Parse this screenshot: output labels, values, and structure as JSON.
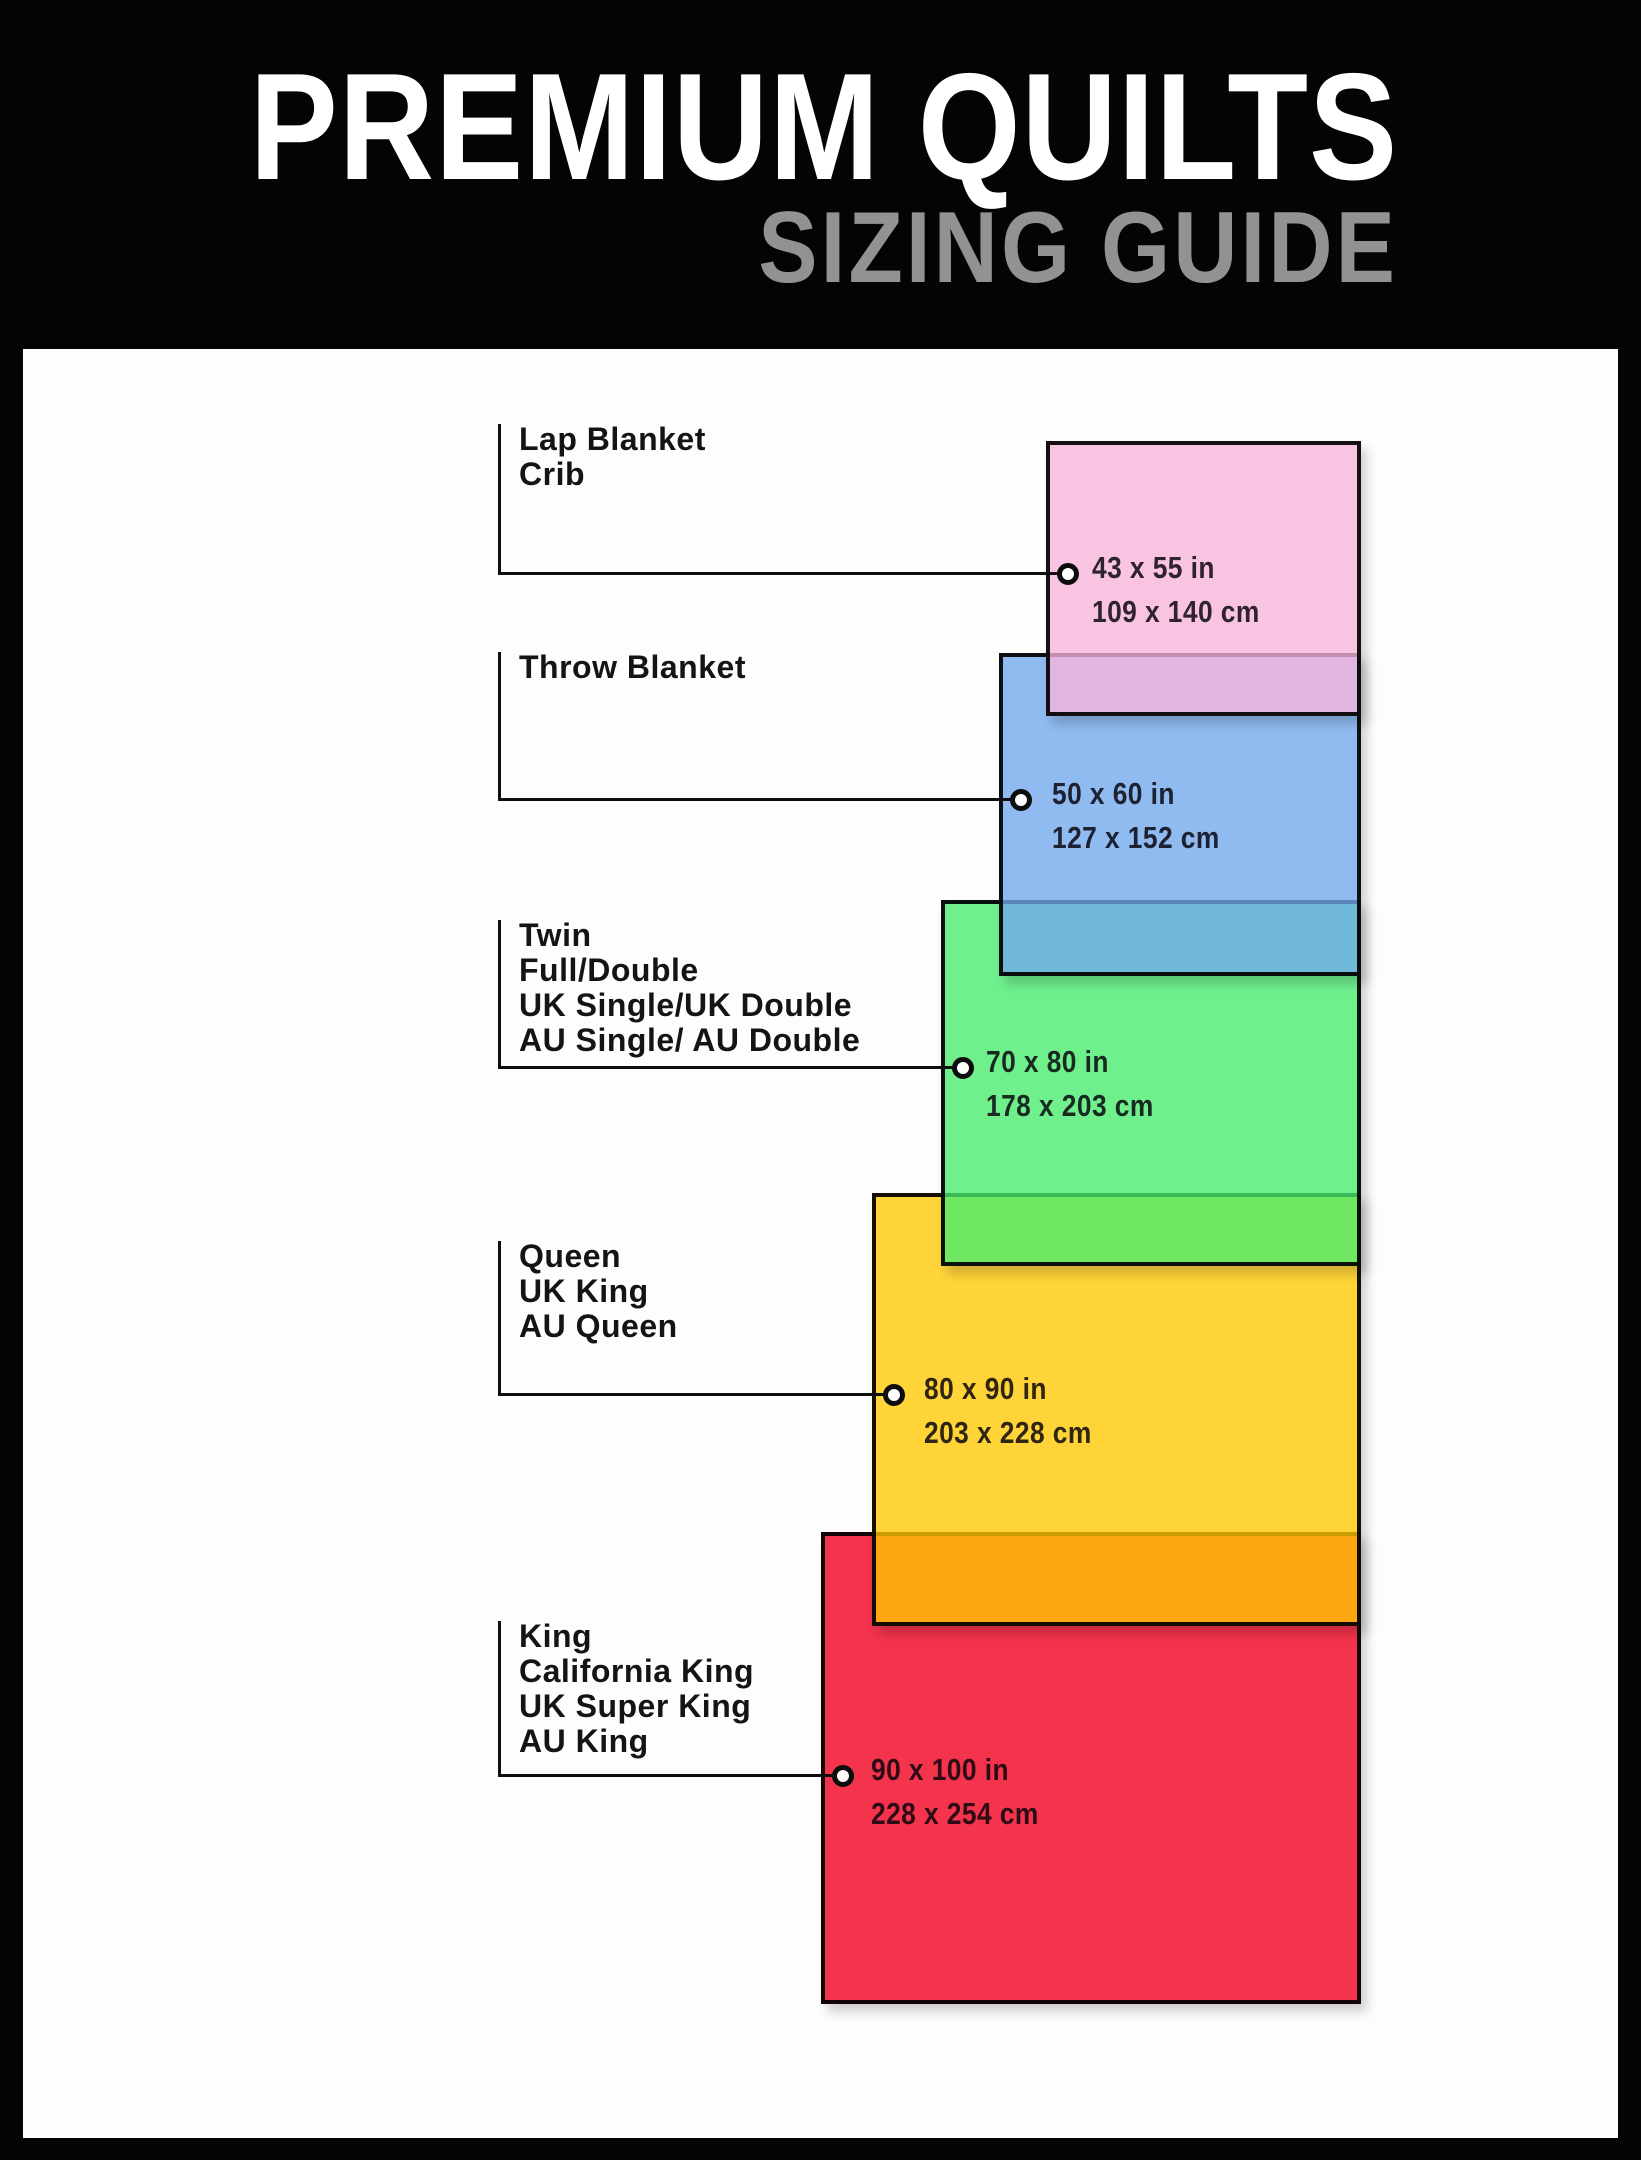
{
  "header": {
    "title": "PREMIUM QUILTS",
    "subtitle": "SIZING GUIDE",
    "background": "#040404",
    "title_color": "#ffffff",
    "subtitle_color": "#929292"
  },
  "layout": {
    "page_width": 1641,
    "page_height": 2160,
    "content_area": {
      "left": 23,
      "top": 349,
      "width": 1595,
      "height": 1789,
      "background": "#fdfdfd"
    },
    "label_text_x": 519,
    "leader_line_x": 498,
    "leader_line_color": "#0e0e0e",
    "rects_right_edge": 1361
  },
  "sizes": [
    {
      "id": "lap-blanket-crib",
      "labels": [
        "Lap Blanket",
        "Crib"
      ],
      "inches": "43 x 55 in",
      "cm": "109 x 140 cm",
      "fill": "rgba(247,179,218,0.78)",
      "display_color": "#f9c4e2",
      "rect": {
        "left": 1046,
        "top": 441,
        "width": 315,
        "height": 275
      },
      "label_y": 422,
      "leader_y": 574,
      "dims_x": 1092,
      "z": 50
    },
    {
      "id": "throw-blanket",
      "labels": [
        "Throw Blanket"
      ],
      "inches": "50 x 60 in",
      "cm": "127 x 152 cm",
      "fill": "rgba(111,168,237,0.78)",
      "display_color": "#8fbbf1",
      "rect": {
        "left": 999,
        "top": 653,
        "width": 362,
        "height": 323
      },
      "label_y": 650,
      "leader_y": 800,
      "dims_x": 1052,
      "z": 40
    },
    {
      "id": "twin-full-double",
      "labels": [
        "Twin",
        "Full/Double",
        "UK Single/UK Double",
        "AU Single/ AU Double"
      ],
      "inches": "70 x 80 in",
      "cm": "178 x 203 cm",
      "fill": "rgba(71,236,109,0.78)",
      "display_color": "#6ff08d",
      "rect": {
        "left": 941,
        "top": 900,
        "width": 420,
        "height": 366
      },
      "label_y": 918,
      "leader_y": 1068,
      "dims_x": 986,
      "z": 30
    },
    {
      "id": "queen-uk-king",
      "labels": [
        "Queen",
        "UK King",
        "AU Queen"
      ],
      "inches": "80 x 90 in",
      "cm": "203 x 228 cm",
      "fill": "rgba(255,200,0,0.78)",
      "display_color": "#ffd40b",
      "rect": {
        "left": 872,
        "top": 1193,
        "width": 489,
        "height": 433
      },
      "label_y": 1239,
      "leader_y": 1395,
      "dims_x": 924,
      "z": 20
    },
    {
      "id": "king-california-king",
      "labels": [
        "King",
        "California King",
        "UK Super King",
        "AU King"
      ],
      "inches": "90 x 100 in",
      "cm": "228 x 254 cm",
      "fill": "rgba(241,0,33,0.80)",
      "display_color": "#f42d52",
      "rect": {
        "left": 821,
        "top": 1532,
        "width": 540,
        "height": 472
      },
      "label_y": 1619,
      "leader_y": 1776,
      "dims_x": 871,
      "z": 10
    }
  ]
}
